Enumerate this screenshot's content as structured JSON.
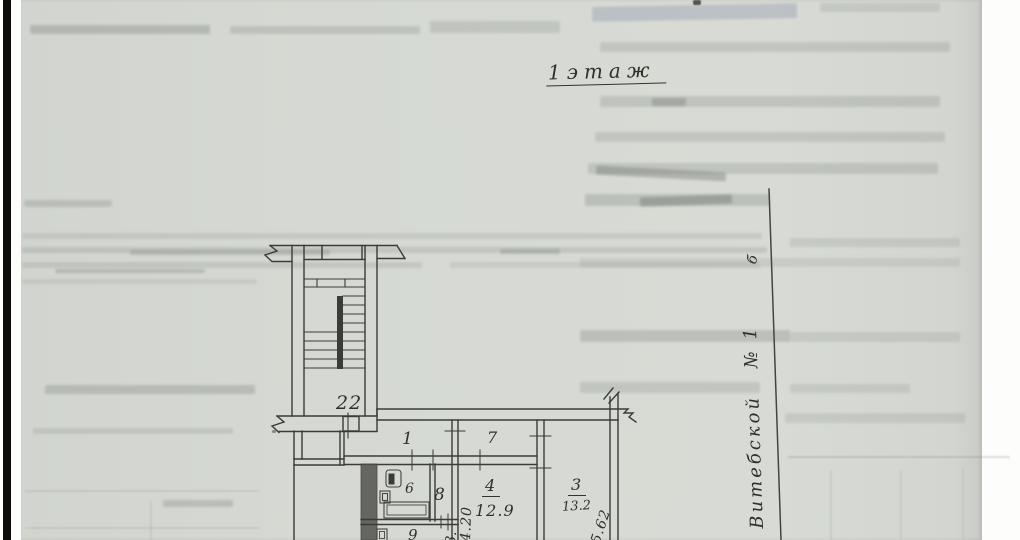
{
  "scan": {
    "floor_label": "1этаж",
    "stairwell_number": "22",
    "street": {
      "name": "Витебской",
      "number": "№ 1",
      "letter": "б"
    },
    "rooms": [
      {
        "id": "1",
        "area": ""
      },
      {
        "id": "7",
        "area": ""
      },
      {
        "id": "6",
        "area": ""
      },
      {
        "id": "8",
        "area": ""
      },
      {
        "id": "4",
        "area": "12.9"
      },
      {
        "id": "3",
        "area": "13.2"
      },
      {
        "id": "9",
        "area": ""
      }
    ],
    "dimensions": {
      "room4_depth": "4.20",
      "room3_depth": "5.62",
      "partial_bottom": "3."
    }
  }
}
